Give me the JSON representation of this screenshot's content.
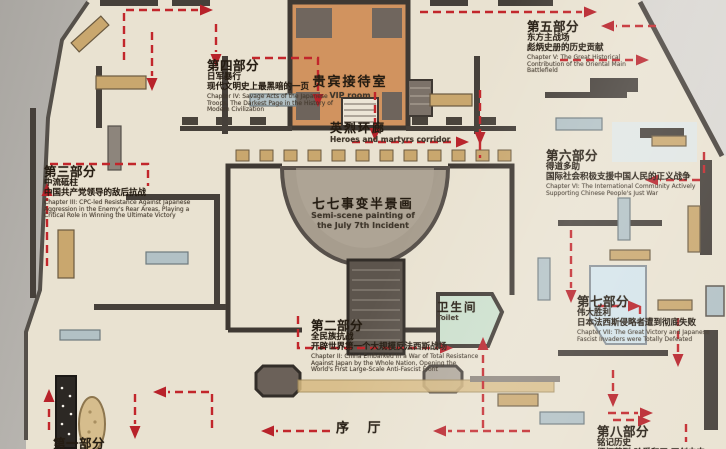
{
  "map": {
    "rooms": {
      "vip": {
        "zh": "贵宾接待室",
        "en": "VIP room"
      },
      "corridor": {
        "zh": "英烈环廊",
        "en": "Heroes and martyrs corridor"
      },
      "panorama": {
        "zh": "七七事变半景画",
        "en1": "Semi-scene painting of",
        "en2": "the July 7th Incident"
      },
      "toilet": {
        "zh": "卫生间",
        "en": "Toilet"
      },
      "lobby": {
        "zh": "序 厅"
      }
    },
    "chapters": [
      {
        "title": "第一部分",
        "sub": "",
        "line": "",
        "en": ""
      },
      {
        "title": "第二部分",
        "sub": "全民族抗战",
        "line": "开辟世界第一个大规模反法西斯战场",
        "en": "Chapter II: China Embarked In a War of Total Resistance Against Japan by the Whole Nation, Opening the World's First Large-Scale Anti-Fascist Front"
      },
      {
        "title": "第三部分",
        "sub": "中流砥柱",
        "line": "中国共产党领导的敌后抗战",
        "en": "Chapter III: CPC-led Resistance Against Japanese Aggression in the Enemy's Rear Areas, Playing a Critical Role in Winning the Ultimate Victory"
      },
      {
        "title": "第四部分",
        "sub": "日军暴行",
        "line": "现代文明史上最黑暗的一页",
        "en": "Chapter IV: Savage Acts of the Japanese Troops, The Darkest Page in the History of Modern Civilization"
      },
      {
        "title": "第五部分",
        "sub": "东方主战场",
        "line": "彪炳史册的历史贡献",
        "en": "Chapter V: The Great Historical Contribution of the Oriental Main Battlefield"
      },
      {
        "title": "第六部分",
        "sub": "得道多助",
        "line": "国际社会积极支援中国人民的正义战争",
        "en": "Chapter VI: The International Community Actively Supporting Chinese People's Just War"
      },
      {
        "title": "第七部分",
        "sub": "伟大胜利",
        "line": "日本法西斯侵略者遭到彻底失败",
        "en": "Chapter VII: The Great Victory and Japanese Fascist Invaders were Totally Defeated"
      },
      {
        "title": "第八部分",
        "sub": "铭记历史",
        "line": "缅怀英烈 珍爱和平 开创未来",
        "en": ""
      }
    ]
  },
  "colors": {
    "route_red": "#c2262b",
    "floor_cream": "#e9e2d1",
    "wall_dark": "#46403a",
    "vip_orange": "#d1935f",
    "toilet_green": "#cbdfcc",
    "furniture_tan": "#c9a76e",
    "furniture_bluegray": "#b2c1c5",
    "photo_background": "#c2bfba"
  }
}
